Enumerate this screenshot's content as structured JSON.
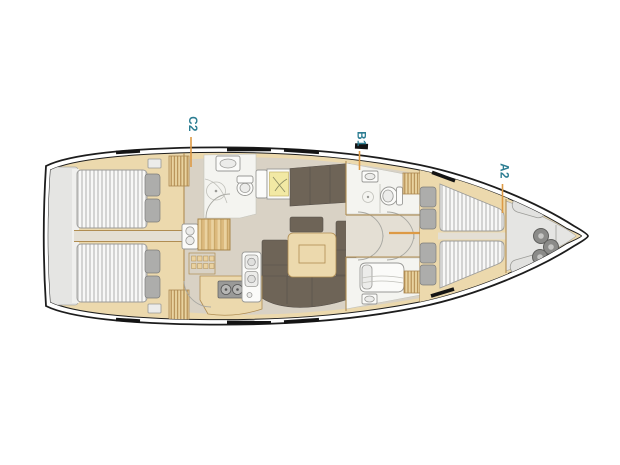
{
  "diagram": {
    "type": "yacht-deck-plan",
    "description": "Top-view sailing yacht interior layout with three annotated cabins",
    "cabin_labels": [
      {
        "id": "cabin-c2",
        "text": "C2",
        "position": "aft"
      },
      {
        "id": "cabin-b1",
        "text": "B1",
        "position": "midship"
      },
      {
        "id": "cabin-a2",
        "text": "A2",
        "position": "fore"
      }
    ],
    "rooms": {
      "aft_port_cabin": "double berth with two pillows",
      "aft_starboard_cabin": "double berth with two pillows",
      "aft_head": "toilet, sink, shower",
      "nav_station": "chart table",
      "saloon": "U-shaped sofa with table and sideboard",
      "galley": "stove, double sink, lockers, companionway steps",
      "mid_head_top": "toilet, sink, shower",
      "mid_head_bottom": "shower room with sink",
      "fore_cabin": "V-berths with four pillows",
      "bow_locker": "sail locker with fenders",
      "transom": "swim platform"
    },
    "colors": {
      "label_text": "#2c7d92",
      "leader_line": "#dd9a45",
      "hull_outline": "#1d1d1d",
      "wood": "#ecd9ad",
      "wood_edge": "#b08d52",
      "floor": "#d9d2c5",
      "floor_light": "#e4dfd4",
      "upholstery_dark": "#6e6457",
      "mattress": "#f8f8f7",
      "mattress_stripe": "#c9c9c7",
      "pillow": "#adadab",
      "bathroom": "#f4f4f0",
      "fixture_outline": "#999996",
      "chart_yellow": "#f2e9a4",
      "stove": "#9a9a98",
      "locker_gray": "#e5e5e3"
    }
  }
}
